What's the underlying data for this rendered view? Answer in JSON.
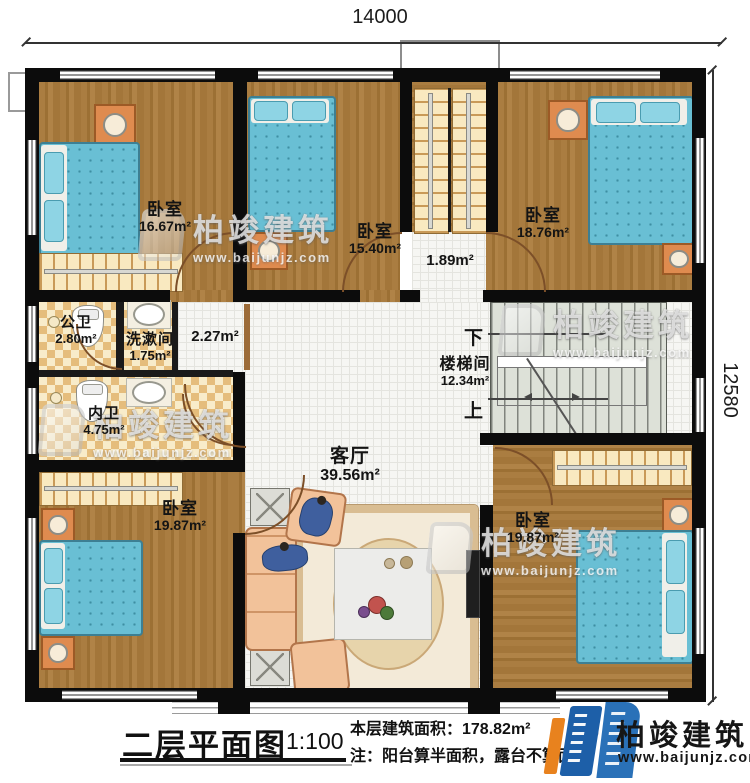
{
  "dimensions": {
    "width_top": "14000",
    "height_right": "12580"
  },
  "rooms": {
    "bedroom_top_left": {
      "name": "卧室",
      "area": "16.67m²"
    },
    "bedroom_top_mid": {
      "name": "卧室",
      "area": "15.40m²"
    },
    "bedroom_top_right": {
      "name": "卧室",
      "area": "18.76m²"
    },
    "hall": {
      "area": "1.89m²"
    },
    "public_bath": {
      "name": "公卫",
      "area": "2.80m²"
    },
    "washroom": {
      "name": "洗漱间",
      "area": "1.75m²"
    },
    "corridor": {
      "area": "2.27m²"
    },
    "private_bath": {
      "name": "内卫",
      "area": "4.75m²"
    },
    "stairwell": {
      "name": "楼梯间",
      "area": "12.34m²",
      "down_label": "下",
      "up_label": "上"
    },
    "living_room": {
      "name": "客厅",
      "area": "39.56m²"
    },
    "bedroom_bottom_left": {
      "name": "卧室",
      "area": "19.87m²"
    },
    "bedroom_bottom_right": {
      "name": "卧室",
      "area": "19.87m²"
    }
  },
  "footer": {
    "title": "二层平面图",
    "scale": "1:100",
    "floor_area": "本层建筑面积：178.82m²",
    "floor_height": "层高",
    "note": "注：阳台算半面积，露台不算面积"
  },
  "brand": {
    "name": "柏竣建筑",
    "url": "www.baijunjz.com"
  },
  "watermark": {
    "name": "柏竣建筑",
    "url": "www.baijunjz.com"
  },
  "colors": {
    "wall": "#0c0c0c",
    "wood": "#a6793c",
    "tile": "#f6f6f3",
    "bed_blue": "#69bfd4",
    "stair_gray": "#dde1d8",
    "brand_blue": "#1d5fa8",
    "brand_orange": "#e8821e"
  }
}
